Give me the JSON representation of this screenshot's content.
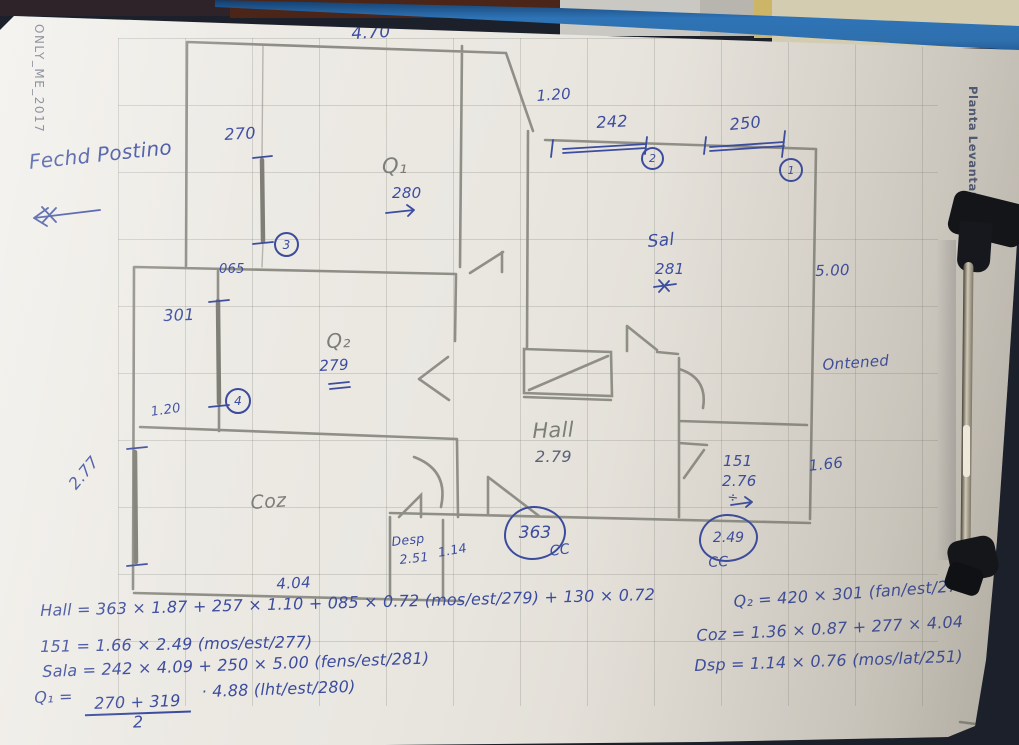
{
  "watermarks": {
    "left": "ONLY_ME_2017",
    "right": "Planta Levantamento"
  },
  "annotations": {
    "fachada_note": "Fechd Postino",
    "outside_note": "Ontened",
    "cc": "CC"
  },
  "rooms": {
    "q1": {
      "label": "Q₁",
      "height": "280"
    },
    "q2": {
      "label": "Q₂",
      "height": "279"
    },
    "sala": {
      "label": "Sal",
      "height": "281",
      "depth": "5.00"
    },
    "hall": {
      "label": "Hall",
      "height": "2.79",
      "width": "363"
    },
    "coz": {
      "label": "Coz",
      "width": "4.04"
    },
    "desp": {
      "label": "Desp",
      "height": "2.51",
      "width": "1.14"
    },
    "r151": {
      "label": "151",
      "height": "2.76",
      "width": "2.49"
    }
  },
  "dimensions": {
    "top_width": "4.70",
    "window3": "270",
    "opening_065": "065",
    "window4": "301",
    "door_gap": "1.20",
    "window_left": "2.77",
    "top_gap": "1.20",
    "window2": "242",
    "window1": "250",
    "right_offset": "1.66"
  },
  "markers": {
    "w1": "1",
    "w2": "2",
    "w3": "3",
    "w4": "4",
    "divide": "÷"
  },
  "equations": {
    "hall": "Hall = 363 × 1.87 + 257 × 1.10 + 085 × 0.72 (mos/est/279) + 130 × 0.72",
    "r151": "151 = 1.66 × 2.49 (mos/est/277)",
    "sala": "Sala = 242 × 4.09 + 250 × 5.00 (fens/est/281)",
    "q1_prefix": "Q₁ =",
    "q1_num": "270 + 319",
    "q1_den": "2",
    "q1_suffix": "· 4.88 (lht/est/280)",
    "q2": "Q₂ = 420 × 301 (fan/est/279)",
    "coz": "Coz = 1.36 × 0.87 + 277 × 4.04",
    "dsp": "Dsp = 1.14 × 0.76 (mos/lat/251)"
  }
}
